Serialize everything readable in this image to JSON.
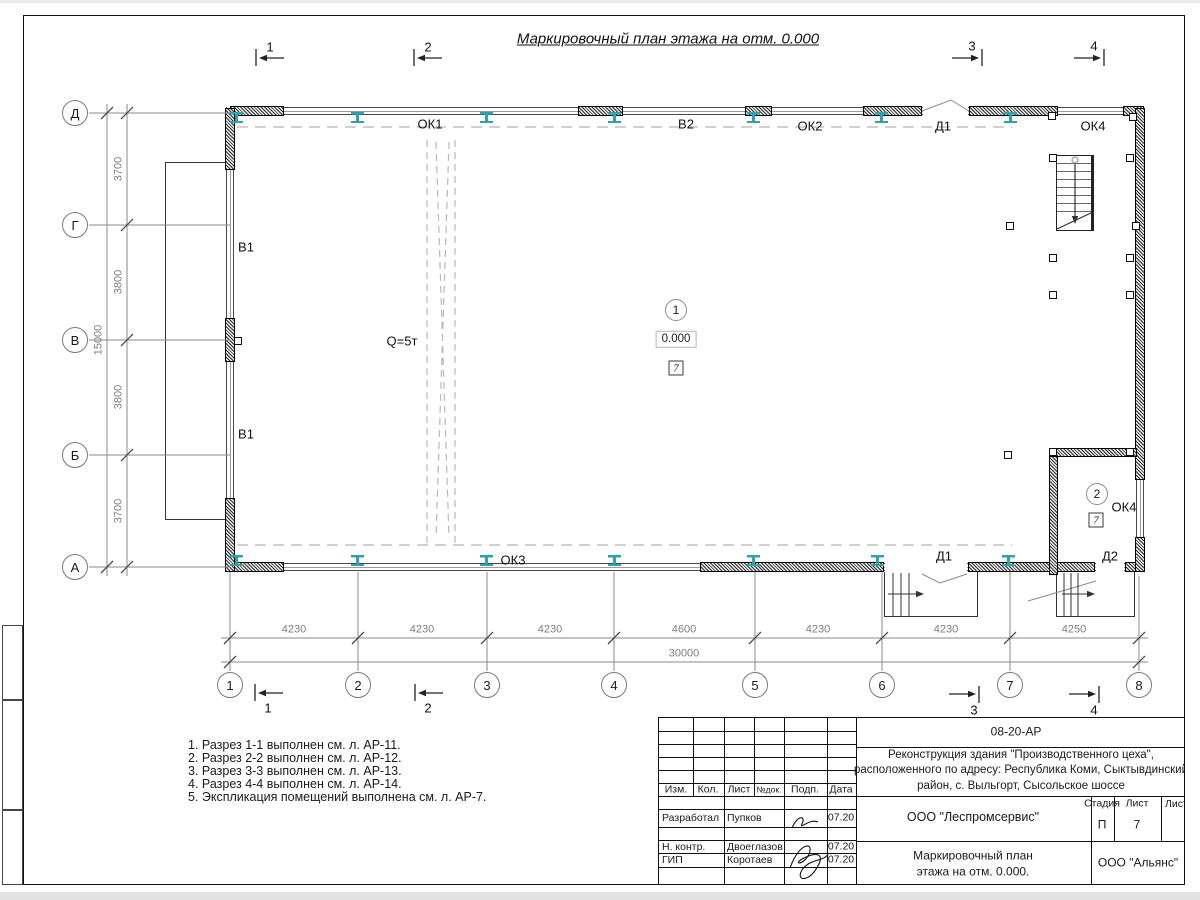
{
  "sheet": {
    "title": "Маркировочный план этажа на отм. 0.000"
  },
  "axes": {
    "rows": [
      "Д",
      "Г",
      "В",
      "Б",
      "А"
    ],
    "cols": [
      "1",
      "2",
      "3",
      "4",
      "5",
      "6",
      "7",
      "8"
    ]
  },
  "dims": {
    "row_segments": [
      "3700",
      "3800",
      "3800",
      "3700"
    ],
    "row_total": "15000",
    "col_segments": [
      "4230",
      "4230",
      "4230",
      "4600",
      "4230",
      "4230",
      "4250"
    ],
    "col_total": "30000"
  },
  "sections": {
    "s1": "1",
    "s2": "2",
    "s3": "3",
    "s4": "4"
  },
  "plan": {
    "ok1": "ОК1",
    "v2": "В2",
    "ok2": "ОК2",
    "d1": "Д1",
    "ok4": "ОК4",
    "v1": "В1",
    "crane": "Q=5т",
    "ok3": "ОК3",
    "d2": "Д2",
    "room1": {
      "number": "1",
      "elevation": "0.000",
      "type": "7"
    },
    "room2": {
      "number": "2",
      "type": "7"
    }
  },
  "notes": [
    "1. Разрез 1-1 выполнен см. л. АР-11.",
    "2. Разрез 2-2 выполнен см. л. АР-12.",
    "3. Разрез 3-3 выполнен см. л. АР-13.",
    "4. Разрез 4-4 выполнен см. л. АР-14.",
    "5. Экспликация помещений выполнена см. л. АР-7."
  ],
  "titleblock": {
    "doc_number": "08-20-АР",
    "project": {
      "line1": "Реконструкция здания \"Производственного цеха\",",
      "line2": "расположенного по адресу: Республика Коми, Сыктывдинский",
      "line3": "район, с. Выльгорт, Сысольское шоссе"
    },
    "columns": {
      "izm": "Изм.",
      "kol": "Кол.",
      "list": "Лист",
      "ndok": "№док.",
      "podp": "Подп.",
      "data": "Дата"
    },
    "rows": [
      {
        "role": "Разработал",
        "name": "Пупков",
        "date": "07.20"
      },
      {
        "role": "Н. контр.",
        "name": "Двоеглазов",
        "date": "07.20"
      },
      {
        "role": "ГИП",
        "name": "Коротаев",
        "date": "07.20"
      }
    ],
    "org": "ООО \"Леспромсервис\"",
    "stage_label": "Стадия",
    "sheet_label": "Лист",
    "sheets_label": "Листов",
    "stage": "П",
    "sheet_no": "7",
    "drawing_title": {
      "line1": "Маркировочный план",
      "line2": "этажа на отм. 0.000."
    },
    "customer": "ООО \"Альянс\""
  },
  "colors": {
    "column_steel": "#2fa3ab",
    "annotation_gray": "#7f7f7f",
    "line_black": "#1a1a1a"
  }
}
